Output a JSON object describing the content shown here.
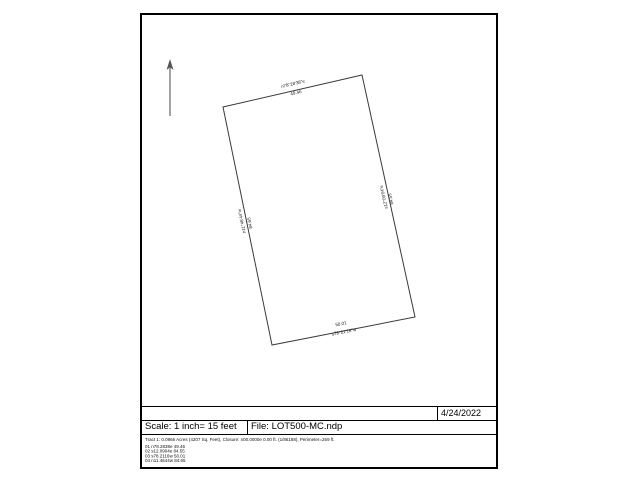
{
  "titleblock": {
    "date": "4/24/2022",
    "scale": "Scale: 1 inch= 15 feet",
    "file": "File: LOT500-MC.ndp",
    "tract_summary": "Tract 1: 0.0966 Acres (4207 Sq. Feet), Closure: n00.0000e 0.00 ft. (1/86188), Perimeter=269 ft.",
    "traverse": [
      "01 n78.2838e 49.46",
      "02 s12.0904e 84.55",
      "03 s78.2116w 50.01",
      "04 n11.4644w 84.65"
    ]
  },
  "parcel": {
    "sides": [
      {
        "bearing": "n78°28'38\"e",
        "distance": "49.46"
      },
      {
        "bearing": "s12°09'04\"e",
        "distance": "84.55"
      },
      {
        "bearing": "s78°21'16\"w",
        "distance": "50.01"
      },
      {
        "bearing": "n11°46'44\"w",
        "distance": "84.65"
      }
    ]
  },
  "icons": {
    "north_arrow": "north-arrow"
  }
}
